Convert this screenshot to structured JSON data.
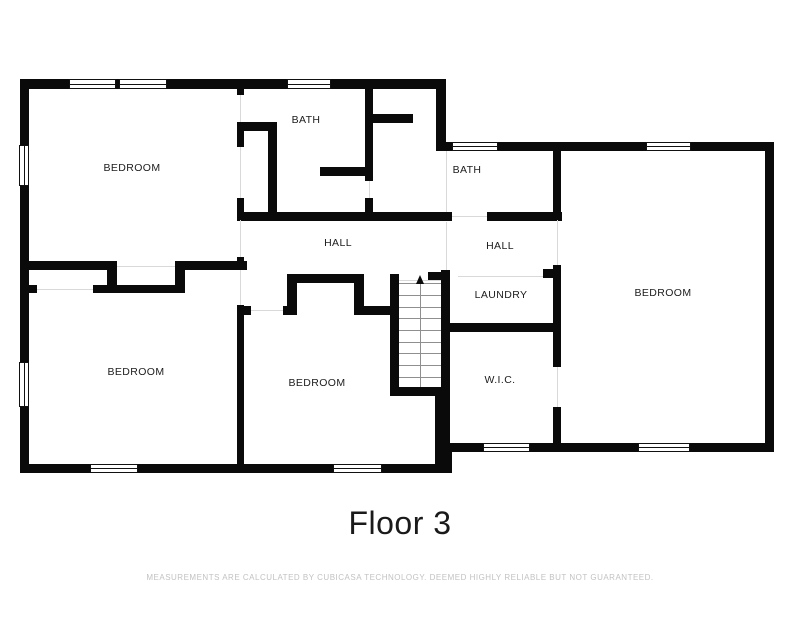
{
  "title": {
    "text": "Floor 3"
  },
  "disclaimer": {
    "text": "MEASUREMENTS ARE CALCULATED BY CUBICASA TECHNOLOGY. DEEMED HIGHLY RELIABLE BUT NOT GUARANTEED."
  },
  "floor_plan": {
    "wall_color": "#0a0a0a",
    "opening_line_color": "#d9d9d9",
    "tread_color": "#8f8f8f",
    "label_color": "#1c1c1c",
    "rooms": [
      {
        "id": "bedroom-top-left",
        "label": "BEDROOM",
        "x": 132,
        "y": 168
      },
      {
        "id": "bath-top",
        "label": "BATH",
        "x": 306,
        "y": 120
      },
      {
        "id": "bath-right",
        "label": "BATH",
        "x": 467,
        "y": 170
      },
      {
        "id": "hall-left",
        "label": "HALL",
        "x": 338,
        "y": 243
      },
      {
        "id": "hall-right",
        "label": "HALL",
        "x": 500,
        "y": 246
      },
      {
        "id": "laundry",
        "label": "LAUNDRY",
        "x": 501,
        "y": 295
      },
      {
        "id": "wic",
        "label": "W.I.C.",
        "x": 500,
        "y": 380
      },
      {
        "id": "bedroom-right",
        "label": "BEDROOM",
        "x": 663,
        "y": 293
      },
      {
        "id": "bedroom-bottom-left",
        "label": "BEDROOM",
        "x": 136,
        "y": 372
      },
      {
        "id": "bedroom-bottom-middle",
        "label": "BEDROOM",
        "x": 317,
        "y": 383
      }
    ],
    "walls": [
      [
        20,
        79,
        426,
        10
      ],
      [
        20,
        79,
        9,
        394
      ],
      [
        20,
        464,
        424,
        9
      ],
      [
        436,
        443,
        16,
        30
      ],
      [
        444,
        443,
        330,
        9
      ],
      [
        765,
        142,
        9,
        310
      ],
      [
        436,
        142,
        338,
        9
      ],
      [
        436,
        79,
        10,
        72
      ],
      [
        237,
        85,
        7,
        10
      ],
      [
        237,
        122,
        7,
        25
      ],
      [
        237,
        198,
        7,
        22
      ],
      [
        237,
        257,
        7,
        13
      ],
      [
        237,
        305,
        7,
        160
      ],
      [
        237,
        122,
        40,
        9
      ],
      [
        268,
        122,
        9,
        92
      ],
      [
        237,
        212,
        215,
        9
      ],
      [
        365,
        85,
        8,
        96
      ],
      [
        365,
        198,
        8,
        23
      ],
      [
        365,
        114,
        48,
        9
      ],
      [
        320,
        167,
        53,
        9
      ],
      [
        487,
        212,
        75,
        9
      ],
      [
        287,
        274,
        77,
        9
      ],
      [
        287,
        283,
        10,
        31
      ],
      [
        354,
        283,
        10,
        31
      ],
      [
        237,
        306,
        14,
        9
      ],
      [
        283,
        306,
        14,
        9
      ],
      [
        354,
        306,
        40,
        9
      ],
      [
        390,
        274,
        9,
        122
      ],
      [
        398,
        387,
        46,
        9
      ],
      [
        435,
        396,
        9,
        70
      ],
      [
        441,
        270,
        9,
        178
      ],
      [
        428,
        272,
        14,
        9
      ],
      [
        543,
        269,
        12,
        9
      ],
      [
        441,
        323,
        116,
        9
      ],
      [
        553,
        150,
        8,
        70
      ],
      [
        553,
        265,
        8,
        102
      ],
      [
        553,
        407,
        8,
        36
      ],
      [
        27,
        261,
        90,
        9
      ],
      [
        175,
        261,
        72,
        9
      ],
      [
        107,
        261,
        10,
        32
      ],
      [
        175,
        261,
        10,
        32
      ],
      [
        27,
        285,
        10,
        8
      ],
      [
        93,
        285,
        92,
        8
      ]
    ],
    "windows": [
      [
        69,
        79,
        47,
        10
      ],
      [
        119,
        79,
        48,
        10
      ],
      [
        287,
        79,
        44,
        10
      ],
      [
        452,
        142,
        46,
        9
      ],
      [
        646,
        142,
        45,
        9
      ],
      [
        19,
        145,
        10,
        41
      ],
      [
        19,
        362,
        10,
        45
      ],
      [
        90,
        464,
        48,
        9
      ],
      [
        333,
        464,
        49,
        9
      ],
      [
        483,
        443,
        47,
        9
      ],
      [
        638,
        443,
        52,
        9
      ]
    ],
    "openings": [
      {
        "o": "v",
        "x": 240,
        "y": 95,
        "len": 27
      },
      {
        "o": "v",
        "x": 240,
        "y": 147,
        "len": 51
      },
      {
        "o": "v",
        "x": 240,
        "y": 220,
        "len": 37
      },
      {
        "o": "v",
        "x": 240,
        "y": 270,
        "len": 35
      },
      {
        "o": "v",
        "x": 369,
        "y": 181,
        "len": 17
      },
      {
        "o": "v",
        "x": 446,
        "y": 151,
        "len": 61
      },
      {
        "o": "v",
        "x": 446,
        "y": 222,
        "len": 48
      },
      {
        "o": "v",
        "x": 557,
        "y": 220,
        "len": 45
      },
      {
        "o": "v",
        "x": 557,
        "y": 367,
        "len": 40
      },
      {
        "o": "h",
        "x": 117,
        "y": 266,
        "len": 58
      },
      {
        "o": "h",
        "x": 37,
        "y": 289,
        "len": 56
      },
      {
        "o": "h",
        "x": 251,
        "y": 310,
        "len": 32
      },
      {
        "o": "h",
        "x": 452,
        "y": 216,
        "len": 35
      },
      {
        "o": "h",
        "x": 458,
        "y": 276,
        "len": 85
      },
      {
        "o": "h",
        "x": 399,
        "y": 280,
        "len": 42
      }
    ],
    "stairs": {
      "left": 399,
      "right": 441,
      "tread_ys": [
        283,
        295,
        307,
        318,
        330,
        342,
        353,
        365,
        377
      ],
      "bottom": 387,
      "center_x": 420,
      "arrow_tip_y": 275,
      "direction": "up"
    }
  }
}
